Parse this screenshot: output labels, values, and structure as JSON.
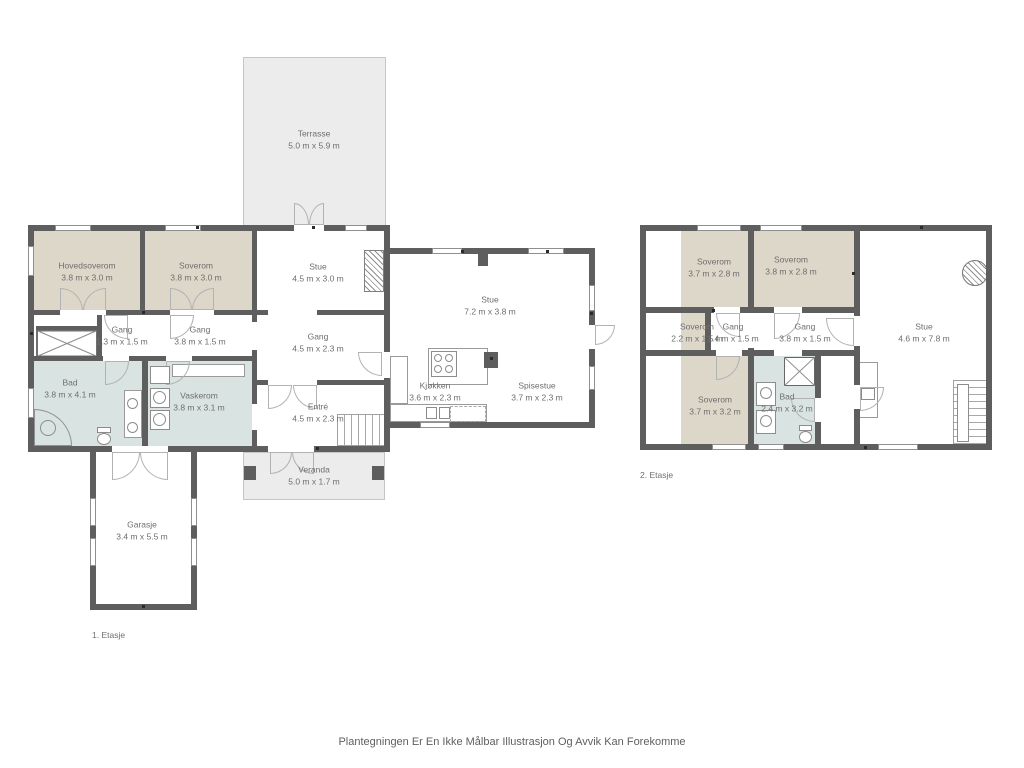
{
  "page": {
    "disclaimer": "Plantegningen Er En Ikke Målbar Illustrasjon Og Avvik Kan Forekomme"
  },
  "colors": {
    "wall": "#5e5e5e",
    "bedroom_fill": "#ddd7c9",
    "wet_room_fill": "#d9e4e2",
    "outdoor_fill": "#ececec",
    "label_text": "#6e6e6e"
  },
  "floor1": {
    "label": "1. Etasje",
    "rooms": [
      {
        "name": "Terrasse",
        "dims": "5.0 m x 5.9 m"
      },
      {
        "name": "Hovedsoverom",
        "dims": "3.8 m x 3.0 m"
      },
      {
        "name": "Soverom",
        "dims": "3.8 m x 3.0 m"
      },
      {
        "name": "Stue",
        "dims": "4.5 m x 3.0 m"
      },
      {
        "name": "Gang",
        "dims": "1.3 m x 1.5 m"
      },
      {
        "name": "Gang",
        "dims": "3.8 m x 1.5 m"
      },
      {
        "name": "Gang",
        "dims": "4.5 m x 2.3 m"
      },
      {
        "name": "Stue",
        "dims": "7.2 m x 3.8 m"
      },
      {
        "name": "Bad",
        "dims": "3.8 m x 4.1 m"
      },
      {
        "name": "Vaskerom",
        "dims": "3.8 m x 3.1 m"
      },
      {
        "name": "Entré",
        "dims": "4.5 m x 2.3 m"
      },
      {
        "name": "Kjøkken",
        "dims": "3.6 m x 2.3 m"
      },
      {
        "name": "Spisestue",
        "dims": "3.7 m x 2.3 m"
      },
      {
        "name": "Veranda",
        "dims": "5.0 m x 1.7 m"
      },
      {
        "name": "Garasje",
        "dims": "3.4 m x 5.5 m"
      }
    ]
  },
  "floor2": {
    "label": "2. Etasje",
    "rooms": [
      {
        "name": "Soverom",
        "dims": "3.7 m x 2.8 m"
      },
      {
        "name": "Soverom",
        "dims": "3.8 m x 2.8 m"
      },
      {
        "name": "Soverom",
        "dims": "2.2 m x 1.5 m"
      },
      {
        "name": "Gang",
        "dims": "1.4 m x 1.5 m"
      },
      {
        "name": "Gang",
        "dims": "3.8 m x 1.5 m"
      },
      {
        "name": "Stue",
        "dims": "4.6 m x 7.8 m"
      },
      {
        "name": "Soverom",
        "dims": "3.7 m x 3.2 m"
      },
      {
        "name": "Bad",
        "dims": "2.4 m x 3.2 m"
      }
    ]
  }
}
